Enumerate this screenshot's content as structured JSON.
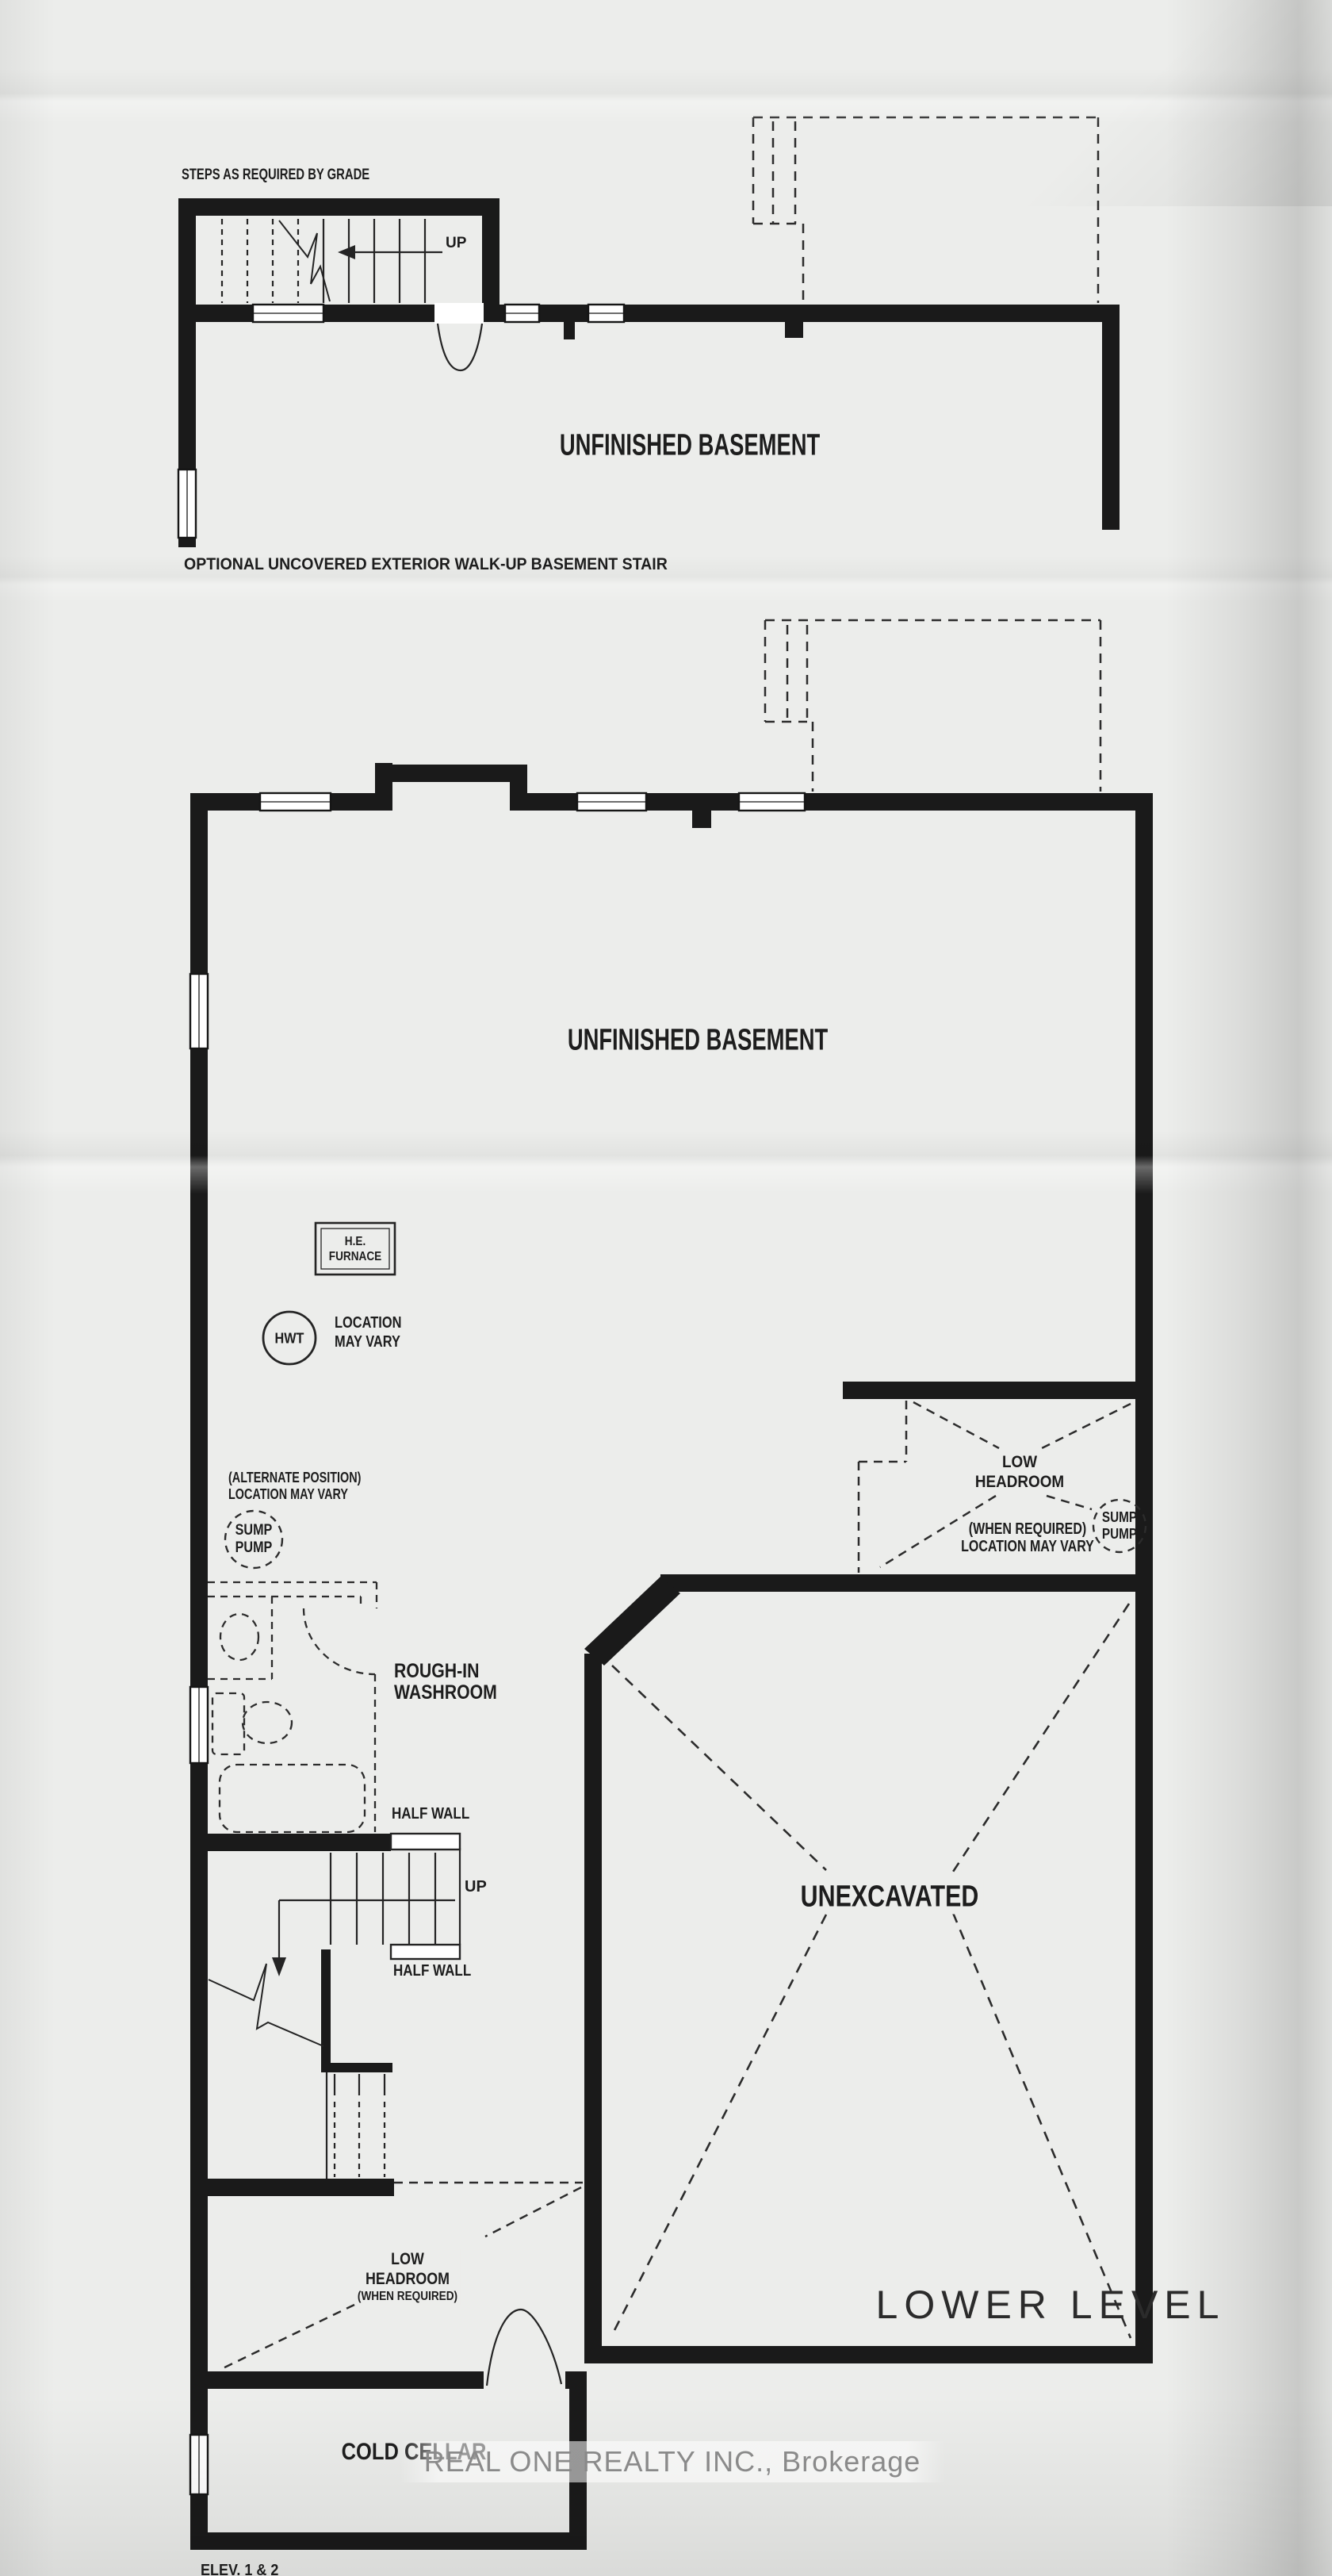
{
  "palette": {
    "paper": "#ecedeb",
    "wall": "#1a1a1a",
    "line": "#262626",
    "dashed_line": "#2c2c2c",
    "watermark_text": "#8a8a8a"
  },
  "top_plan": {
    "steps_note": "STEPS AS REQUIRED BY GRADE",
    "up_label": "UP",
    "room_label": "UNFINISHED BASEMENT",
    "caption": "OPTIONAL UNCOVERED EXTERIOR WALK-UP BASEMENT STAIR"
  },
  "main_plan": {
    "room_label": "UNFINISHED BASEMENT",
    "furnace_line1": "H.E.",
    "furnace_line2": "FURNACE",
    "hwt_label": "HWT",
    "hwt_note_line1": "LOCATION",
    "hwt_note_line2": "MAY VARY",
    "alt_note_line1": "(ALTERNATE POSITION)",
    "alt_note_line2": "LOCATION MAY VARY",
    "sump_left_line1": "SUMP",
    "sump_left_line2": "PUMP",
    "low_headroom_right_line1": "LOW",
    "low_headroom_right_line2": "HEADROOM",
    "when_required_right_line1": "(WHEN REQUIRED)",
    "when_required_right_line2": "LOCATION MAY VARY",
    "sump_right_line1": "SUMP",
    "sump_right_line2": "PUMP",
    "washroom_line1": "ROUGH-IN",
    "washroom_line2": "WASHROOM",
    "half_wall_upper": "HALF WALL",
    "up_label": "UP",
    "half_wall_lower": "HALF WALL",
    "unexcavated_label": "UNEXCAVATED",
    "low_headroom_bottom_line1": "LOW",
    "low_headroom_bottom_line2": "HEADROOM",
    "low_headroom_bottom_line3": "(WHEN REQUIRED)",
    "cold_cellar_label": "COLD CELLAR"
  },
  "footer": {
    "plan_title": "LOWER LEVEL",
    "watermark": "REAL ONE REALTY INC., Brokerage",
    "elevation_note": "ELEV. 1 & 2"
  }
}
